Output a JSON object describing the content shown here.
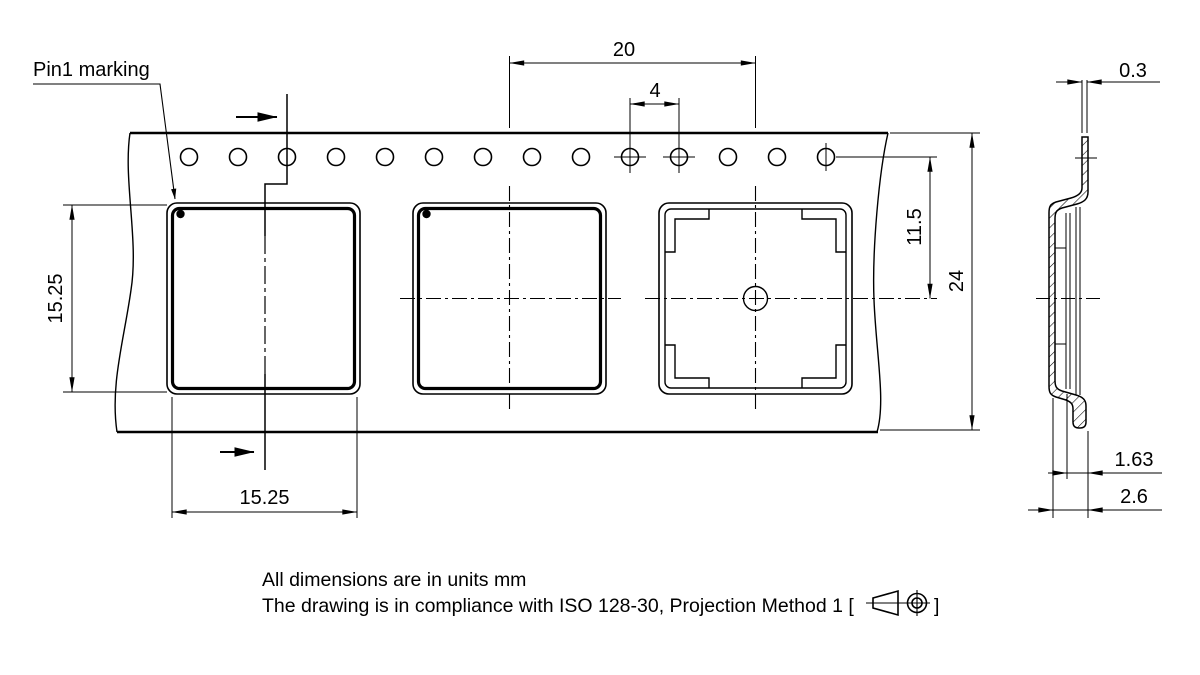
{
  "drawing": {
    "pin1_label": "Pin1 marking",
    "dimensions": {
      "pocket_pitch": "20",
      "sprocket_hole_pitch": "4",
      "pocket_height": "15.25",
      "pocket_width": "15.25",
      "hole_center_to_pocket_center": "11.5",
      "tape_width": "24",
      "tape_thickness": "0.3",
      "pocket_inner_depth": "1.63",
      "pocket_total_depth": "2.6"
    },
    "notes": {
      "line1": "All dimensions are in units mm",
      "line2_prefix": "The drawing is in compliance with ISO 128-30, Projection Method 1 [",
      "line2_suffix": "]"
    },
    "colors": {
      "line": "#000000",
      "background": "#ffffff"
    }
  }
}
